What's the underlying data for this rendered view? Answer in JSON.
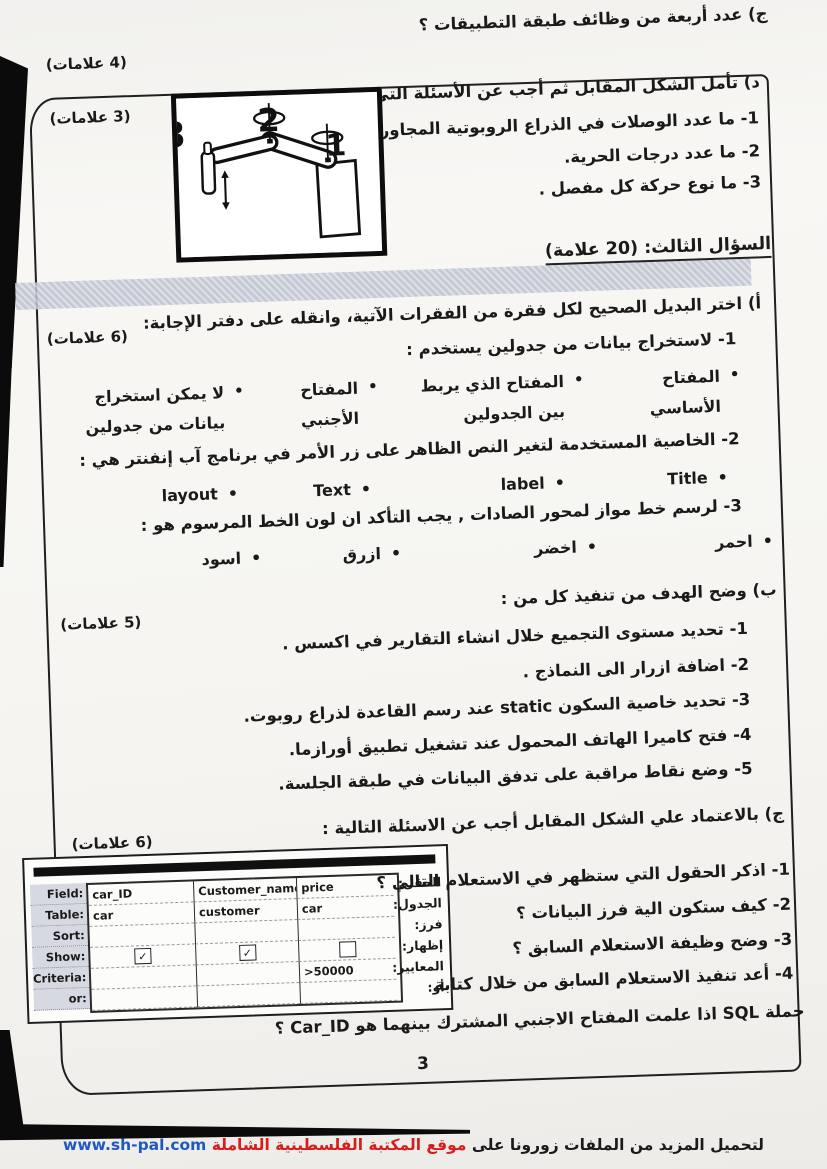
{
  "top_section": {
    "q_c": "ج) عدد أربعة من وظائف طبقة التطبيقات ؟",
    "q_c_marks": "(4 علامات)",
    "q_d_intro": "د) تأمل الشكل المقابل ثم أجب عن الأسئلة التي تليه:",
    "q_d_marks": "(3 علامات)",
    "q_d_items": [
      "1- ما عدد الوصلات في الذراع الروبوتية المجاورة .",
      "2- ما عدد درجات الحرية.",
      "3- ما نوع حركة كل مفصل ."
    ],
    "figure": {
      "label_1": "1",
      "label_2": "2",
      "label_3": "3"
    }
  },
  "section3": {
    "heading": "السؤال الثالث: (20 علامة)",
    "part_a": {
      "marks": "(6 علامات)",
      "intro": "أ)  اختر البديل الصحيح لكل فقرة من الفقرات الآتية، وانقله على دفتر الإجابة:",
      "q1": "1-  لاستخراج بيانات من جدولين يستخدم :",
      "q1_options": [
        "المفتاح الأساسي",
        "المفتاح الذي يربط بين الجدولين",
        "المفتاح الأجنبي",
        "لا يمكن استخراج بيانات من جدولين"
      ],
      "q2": "2-  الخاصية المستخدمة لتغير النص الظاهر على زر الأمر في برنامج آب إنفنتر هي :",
      "q2_options": [
        "Title",
        "label",
        "Text",
        "layout"
      ],
      "q3": "3-  لرسم خط مواز لمحور الصادات , يجب التأكد ان لون الخط المرسوم هو :",
      "q3_options": [
        "احمر",
        "اخضر",
        "ازرق",
        "اسود"
      ]
    },
    "part_b": {
      "marks": "(5 علامات)",
      "intro": "ب) وضح الهدف من تنفيذ كل من :",
      "items": [
        "1-  تحديد مستوى التجميع خلال انشاء التقارير في اكسس .",
        "2-  اضافة ازرار الى النماذج .",
        "3- تحديد خاصية السكون static عند رسم القاعدة لذراع روبوت.",
        "4- فتح كاميرا الهاتف المحمول عند تشغيل تطبيق أورازما.",
        "5- وضع نقاط مراقبة على تدفق البيانات في  طبقة الجلسة."
      ]
    },
    "part_c": {
      "marks": "(6 علامات)",
      "intro": "ج) بالاعتماد علي الشكل المقابل أجب عن الاسئلة التالية :",
      "questions": [
        "1- اذكر الحقول التي ستظهر في الاستعلام التالي ؟",
        "2- كيف ستكون الية  فرز البيانات  ؟",
        "3- وضح وظيفة الاستعلام السابق ؟",
        "4- أعد تنفيذ الاستعلام السابق من خلال كتابة"
      ],
      "sql_line": "جملة  SQL  اذا علمت المفتاح الاجنبي المشترك بينهما هو Car_ID ؟"
    }
  },
  "query_grid": {
    "rows_en": [
      "Field:",
      "Table:",
      "Sort:",
      "Show:",
      "Criteria:",
      "or:"
    ],
    "rows_ar": [
      "الحقل:",
      "الجدول:",
      "فرز:",
      "إظهار:",
      "المعايير:",
      "أو:"
    ],
    "field_row": [
      "car_ID",
      "Customer_name",
      "price"
    ],
    "table_row": [
      "car",
      "customer",
      "car"
    ],
    "show_marks": [
      "✓",
      "✓",
      ""
    ],
    "criteria_row": [
      "",
      "",
      ">50000"
    ]
  },
  "footer": {
    "page_number": "3",
    "text_black": "لتحميل المزيد من الملفات زورونا على",
    "text_red": "موقع المكتبة الفلسطينية الشاملة",
    "site": "www.sh-pal.com",
    "color_red": "#d61c1c",
    "color_blue": "#1d5ac0",
    "highlight_gray": "#c7ccd8"
  }
}
